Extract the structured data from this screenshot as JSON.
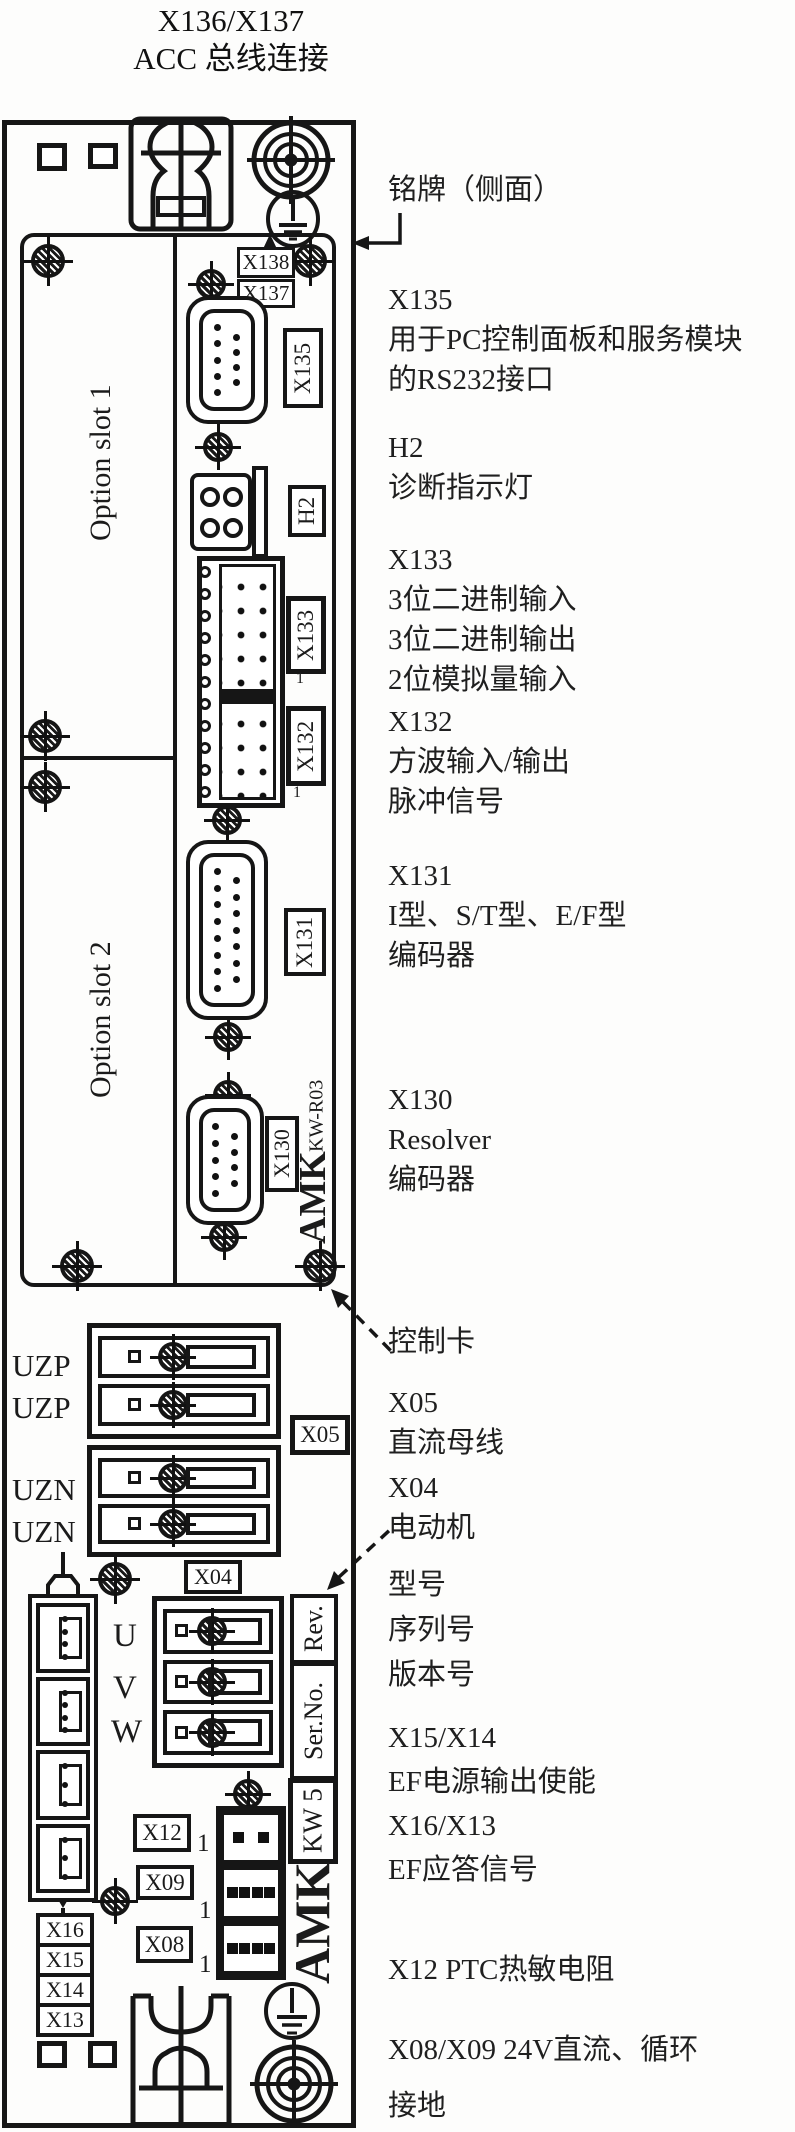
{
  "title": {
    "line1": "X136/X137",
    "line2": "ACC 总线连接"
  },
  "annotations": {
    "nameplate": {
      "lines": [
        "铭牌（侧面）"
      ]
    },
    "x135": {
      "lines": [
        "X135",
        "用于PC控制面板和服务模块",
        "的RS232接口"
      ]
    },
    "h2": {
      "lines": [
        "H2",
        "诊断指示灯"
      ]
    },
    "x133": {
      "lines": [
        "X133",
        "3位二进制输入",
        "3位二进制输出",
        "2位模拟量输入"
      ]
    },
    "x132": {
      "lines": [
        "X132",
        "方波输入/输出",
        "脉冲信号"
      ]
    },
    "x131": {
      "lines": [
        "X131",
        "I型、S/T型、E/F型",
        "编码器"
      ]
    },
    "x130": {
      "lines": [
        "X130",
        "Resolver",
        "编码器"
      ]
    },
    "control_card": {
      "lines": [
        "控制卡"
      ]
    },
    "x05": {
      "lines": [
        "X05",
        "直流母线"
      ]
    },
    "x04": {
      "lines": [
        "X04",
        "电动机"
      ]
    },
    "nameplate_fields": {
      "lines": [
        "型号",
        "序列号",
        "版本号"
      ]
    },
    "x15x14": {
      "lines": [
        "X15/X14",
        "EF电源输出使能",
        "X16/X13",
        "EF应答信号"
      ]
    },
    "x12ptc": {
      "lines": [
        "X12 PTC热敏电阻"
      ]
    },
    "x08x09": {
      "lines": [
        "X08/X09 24V直流、循环"
      ]
    },
    "ground": {
      "lines": [
        "接地"
      ]
    }
  },
  "device": {
    "slot1": "Option slot 1",
    "slot2": "Option slot 2",
    "x138": "X138",
    "x137": "X137",
    "x135": "X135",
    "h2": "H2",
    "x133": "X133",
    "x132": "X132",
    "x131": "X131",
    "x130": "X130",
    "kw_r03": "KW-R03",
    "amk_logo": "AMK",
    "uzp1": "UZP",
    "uzp2": "UZP",
    "uzn1": "UZN",
    "uzn2": "UZN",
    "x05": "X05",
    "x04": "X04",
    "u": "U",
    "v": "V",
    "w": "W",
    "rev": "Rev.",
    "serno": "Ser.No.",
    "kw5": "KW 5",
    "x12": "X12",
    "x09": "X09",
    "x08": "X08",
    "x16": "X16",
    "x15": "X15",
    "x14": "X14",
    "x13": "X13",
    "pin_marker": "1"
  },
  "symbols": {
    "screw": "cross-slot-screw-icon",
    "target": "concentric-torx-screw-icon",
    "earth": "protective-earth-icon",
    "acc_connector": "acc-bus-connector-icon"
  },
  "colors": {
    "line": "#161616",
    "text": "#1f1f1f",
    "background": "#fdfdfc"
  }
}
